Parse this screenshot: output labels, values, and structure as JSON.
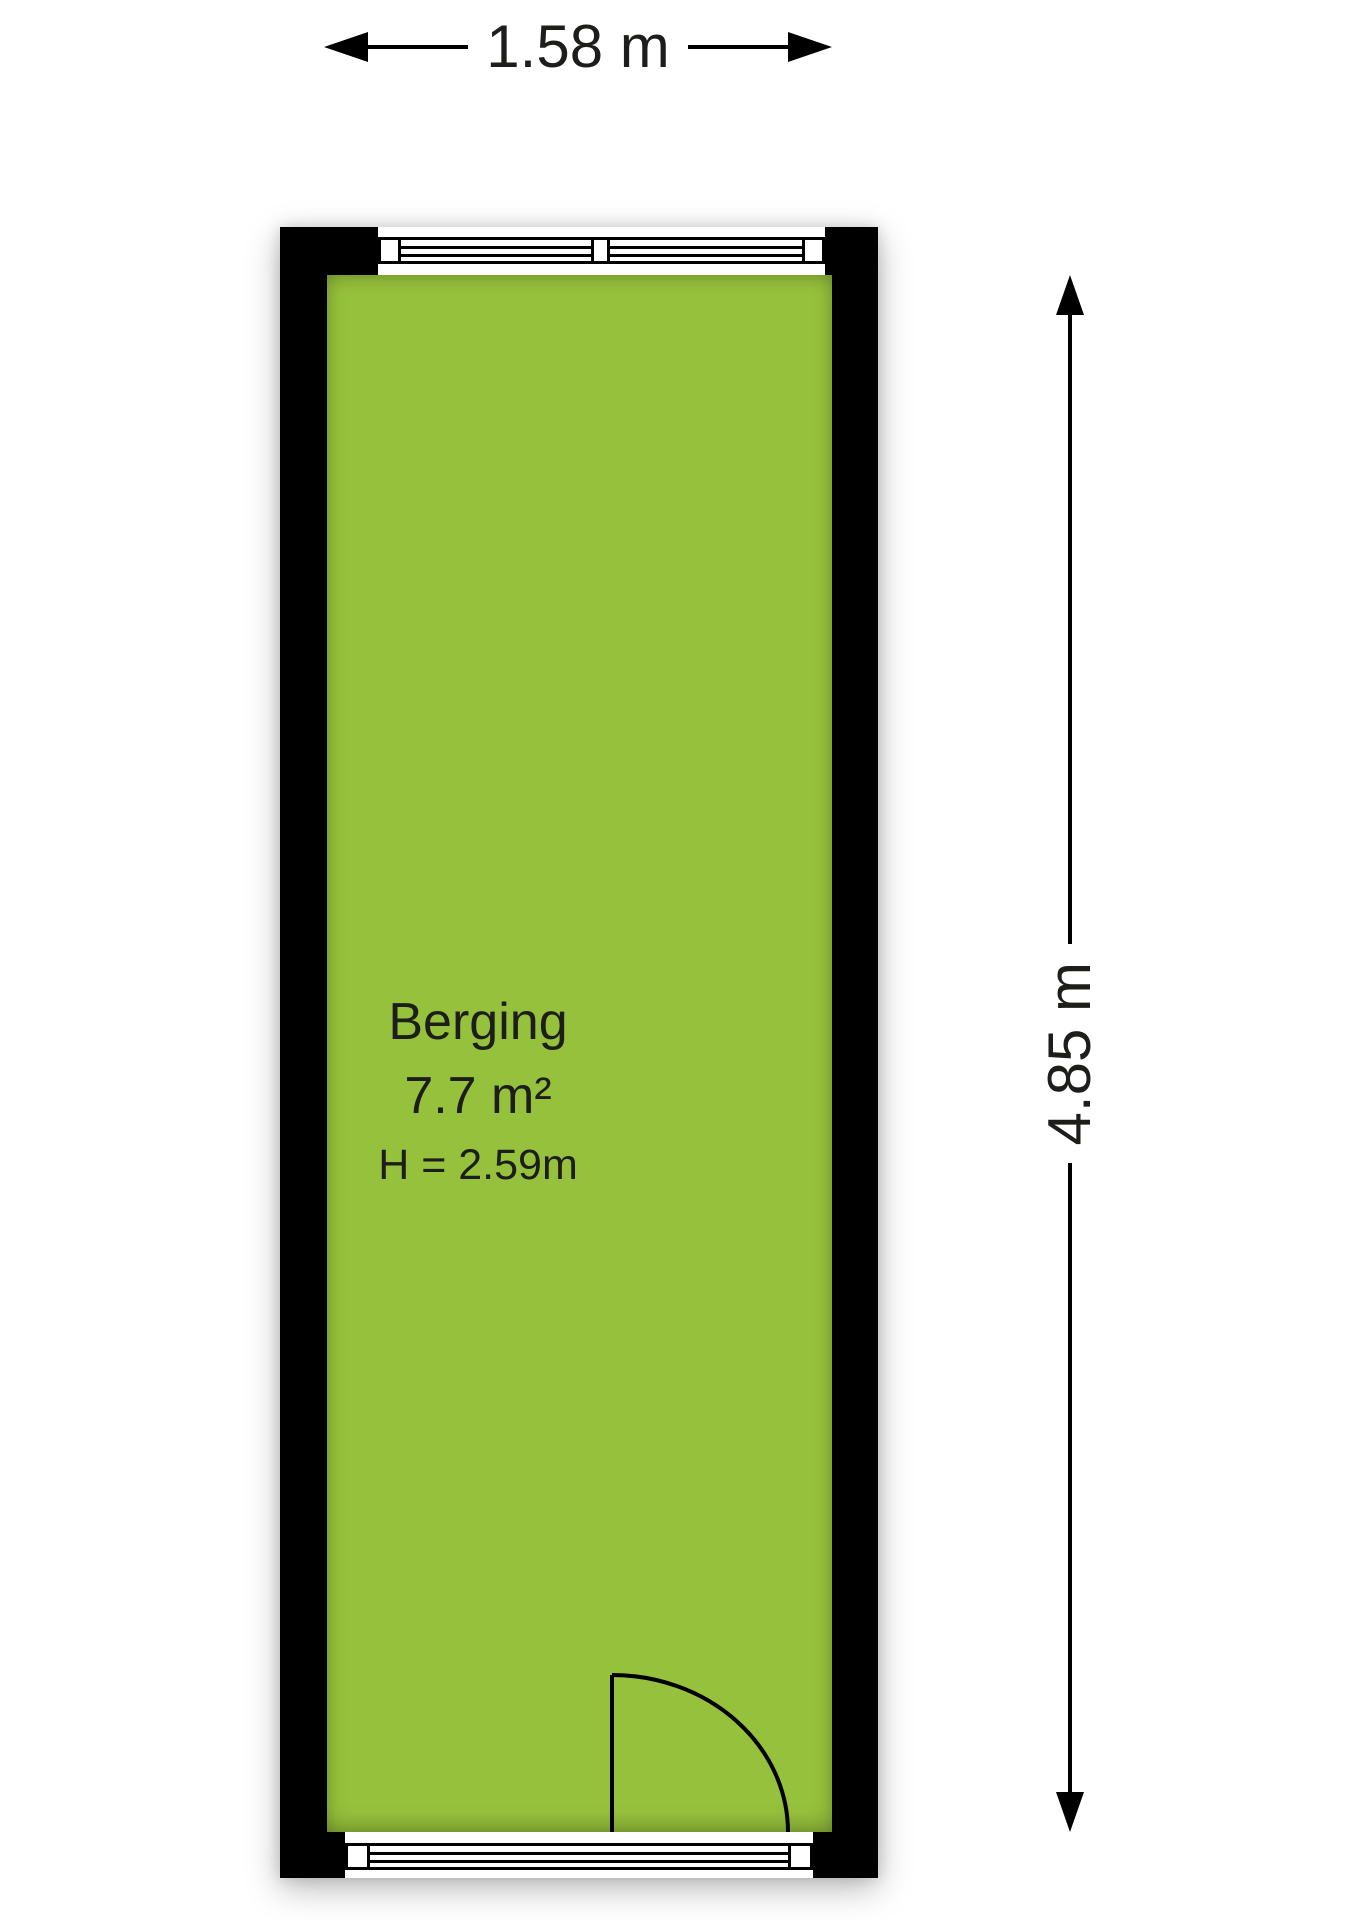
{
  "room": {
    "name": "Berging",
    "area": "7.7 m²",
    "ceiling_height": "H = 2.59m"
  },
  "dimensions": {
    "width_label": "1.58 m",
    "height_label": "4.85 m"
  },
  "icons": {
    "top_left": "arrow-left-icon",
    "top_right": "arrow-right-icon",
    "side_up": "arrow-up-icon",
    "side_down": "arrow-down-icon"
  },
  "colors": {
    "floor": "#96c13c",
    "wall": "#000000",
    "ink": "#1d1d1b"
  }
}
